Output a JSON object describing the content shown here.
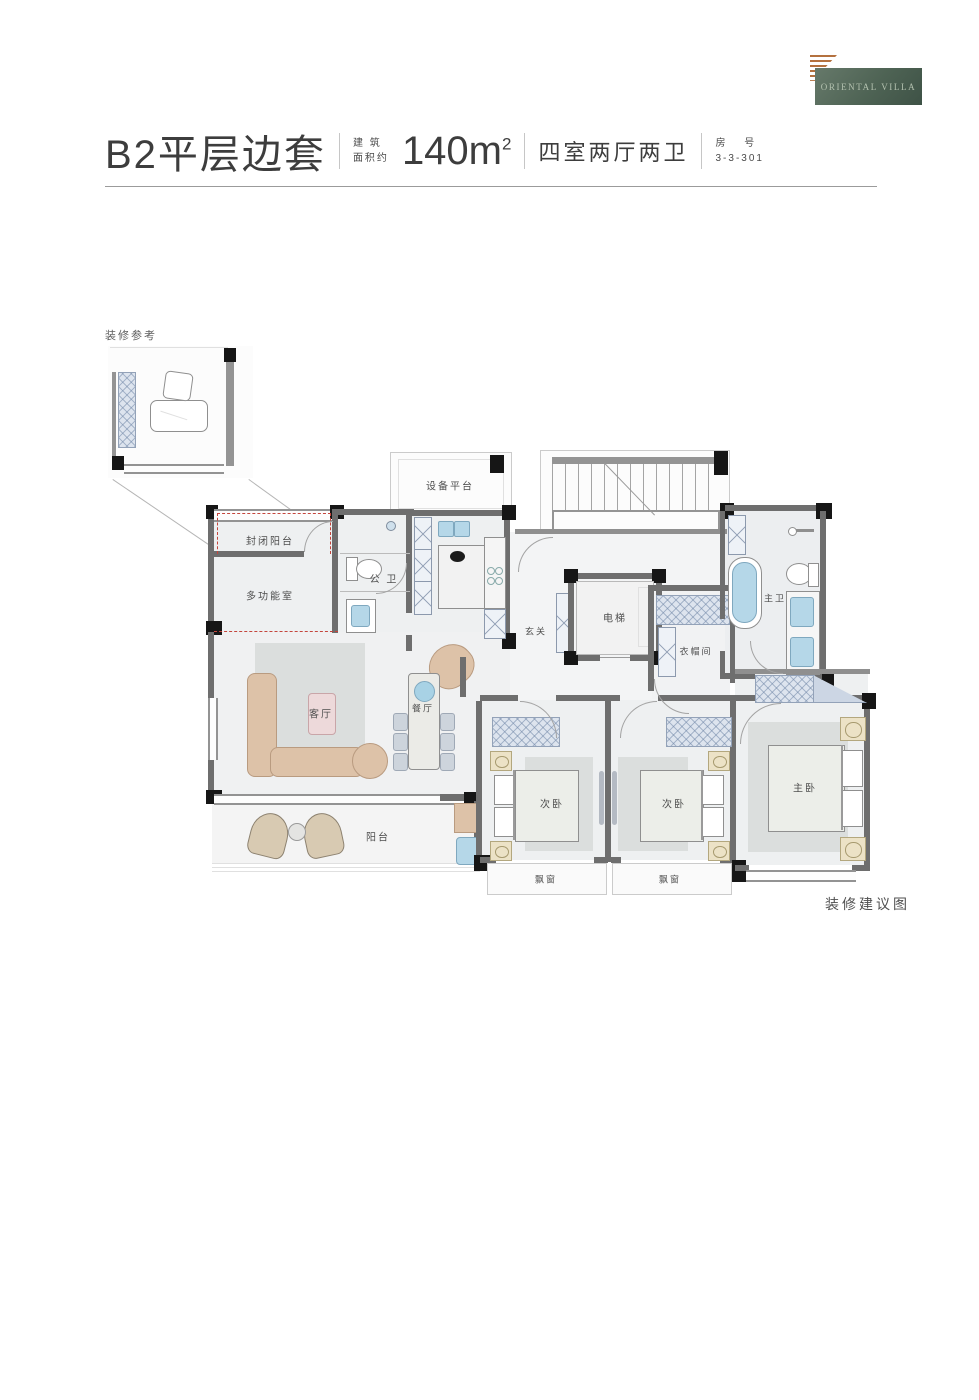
{
  "logo": {
    "text": "ORIENTAL VILLA"
  },
  "header": {
    "plan_name": "B2平层边套",
    "area_prefix_top": "建 筑",
    "area_prefix_bottom": "面积约",
    "area_value": "140m",
    "area_sup": "2",
    "layout_desc": "四室两厅两卫",
    "room_no_top": "房 号",
    "room_no_bottom": "3-3-301"
  },
  "inset": {
    "label": "装修参考"
  },
  "plan": {
    "rooms": {
      "equipment_platform": "设备平台",
      "enclosed_balcony": "封闭阳台",
      "multi_function_room": "多功能室",
      "public_bathroom": "公 卫",
      "foyer": "玄关",
      "elevator": "电梯",
      "cloakroom": "衣帽间",
      "master_bathroom": "主卫",
      "living_room": "客厅",
      "dining_room": "餐厅",
      "balcony": "阳台",
      "secondary_bedroom": "次卧",
      "master_bedroom": "主卧",
      "bay_window": "飘窗"
    },
    "caption": "装修建议图"
  },
  "colors": {
    "logo_green": "#4e6354",
    "logo_accent_orange": "#b4713f",
    "wall_gray": "#6e6e6e",
    "corner_black": "#161616",
    "floor_gray": "#eef0f1",
    "fixture_blue": "#b5d7e8",
    "furniture_tan": "#ddc2a8",
    "accent_red_dashed": "#c4453c"
  }
}
